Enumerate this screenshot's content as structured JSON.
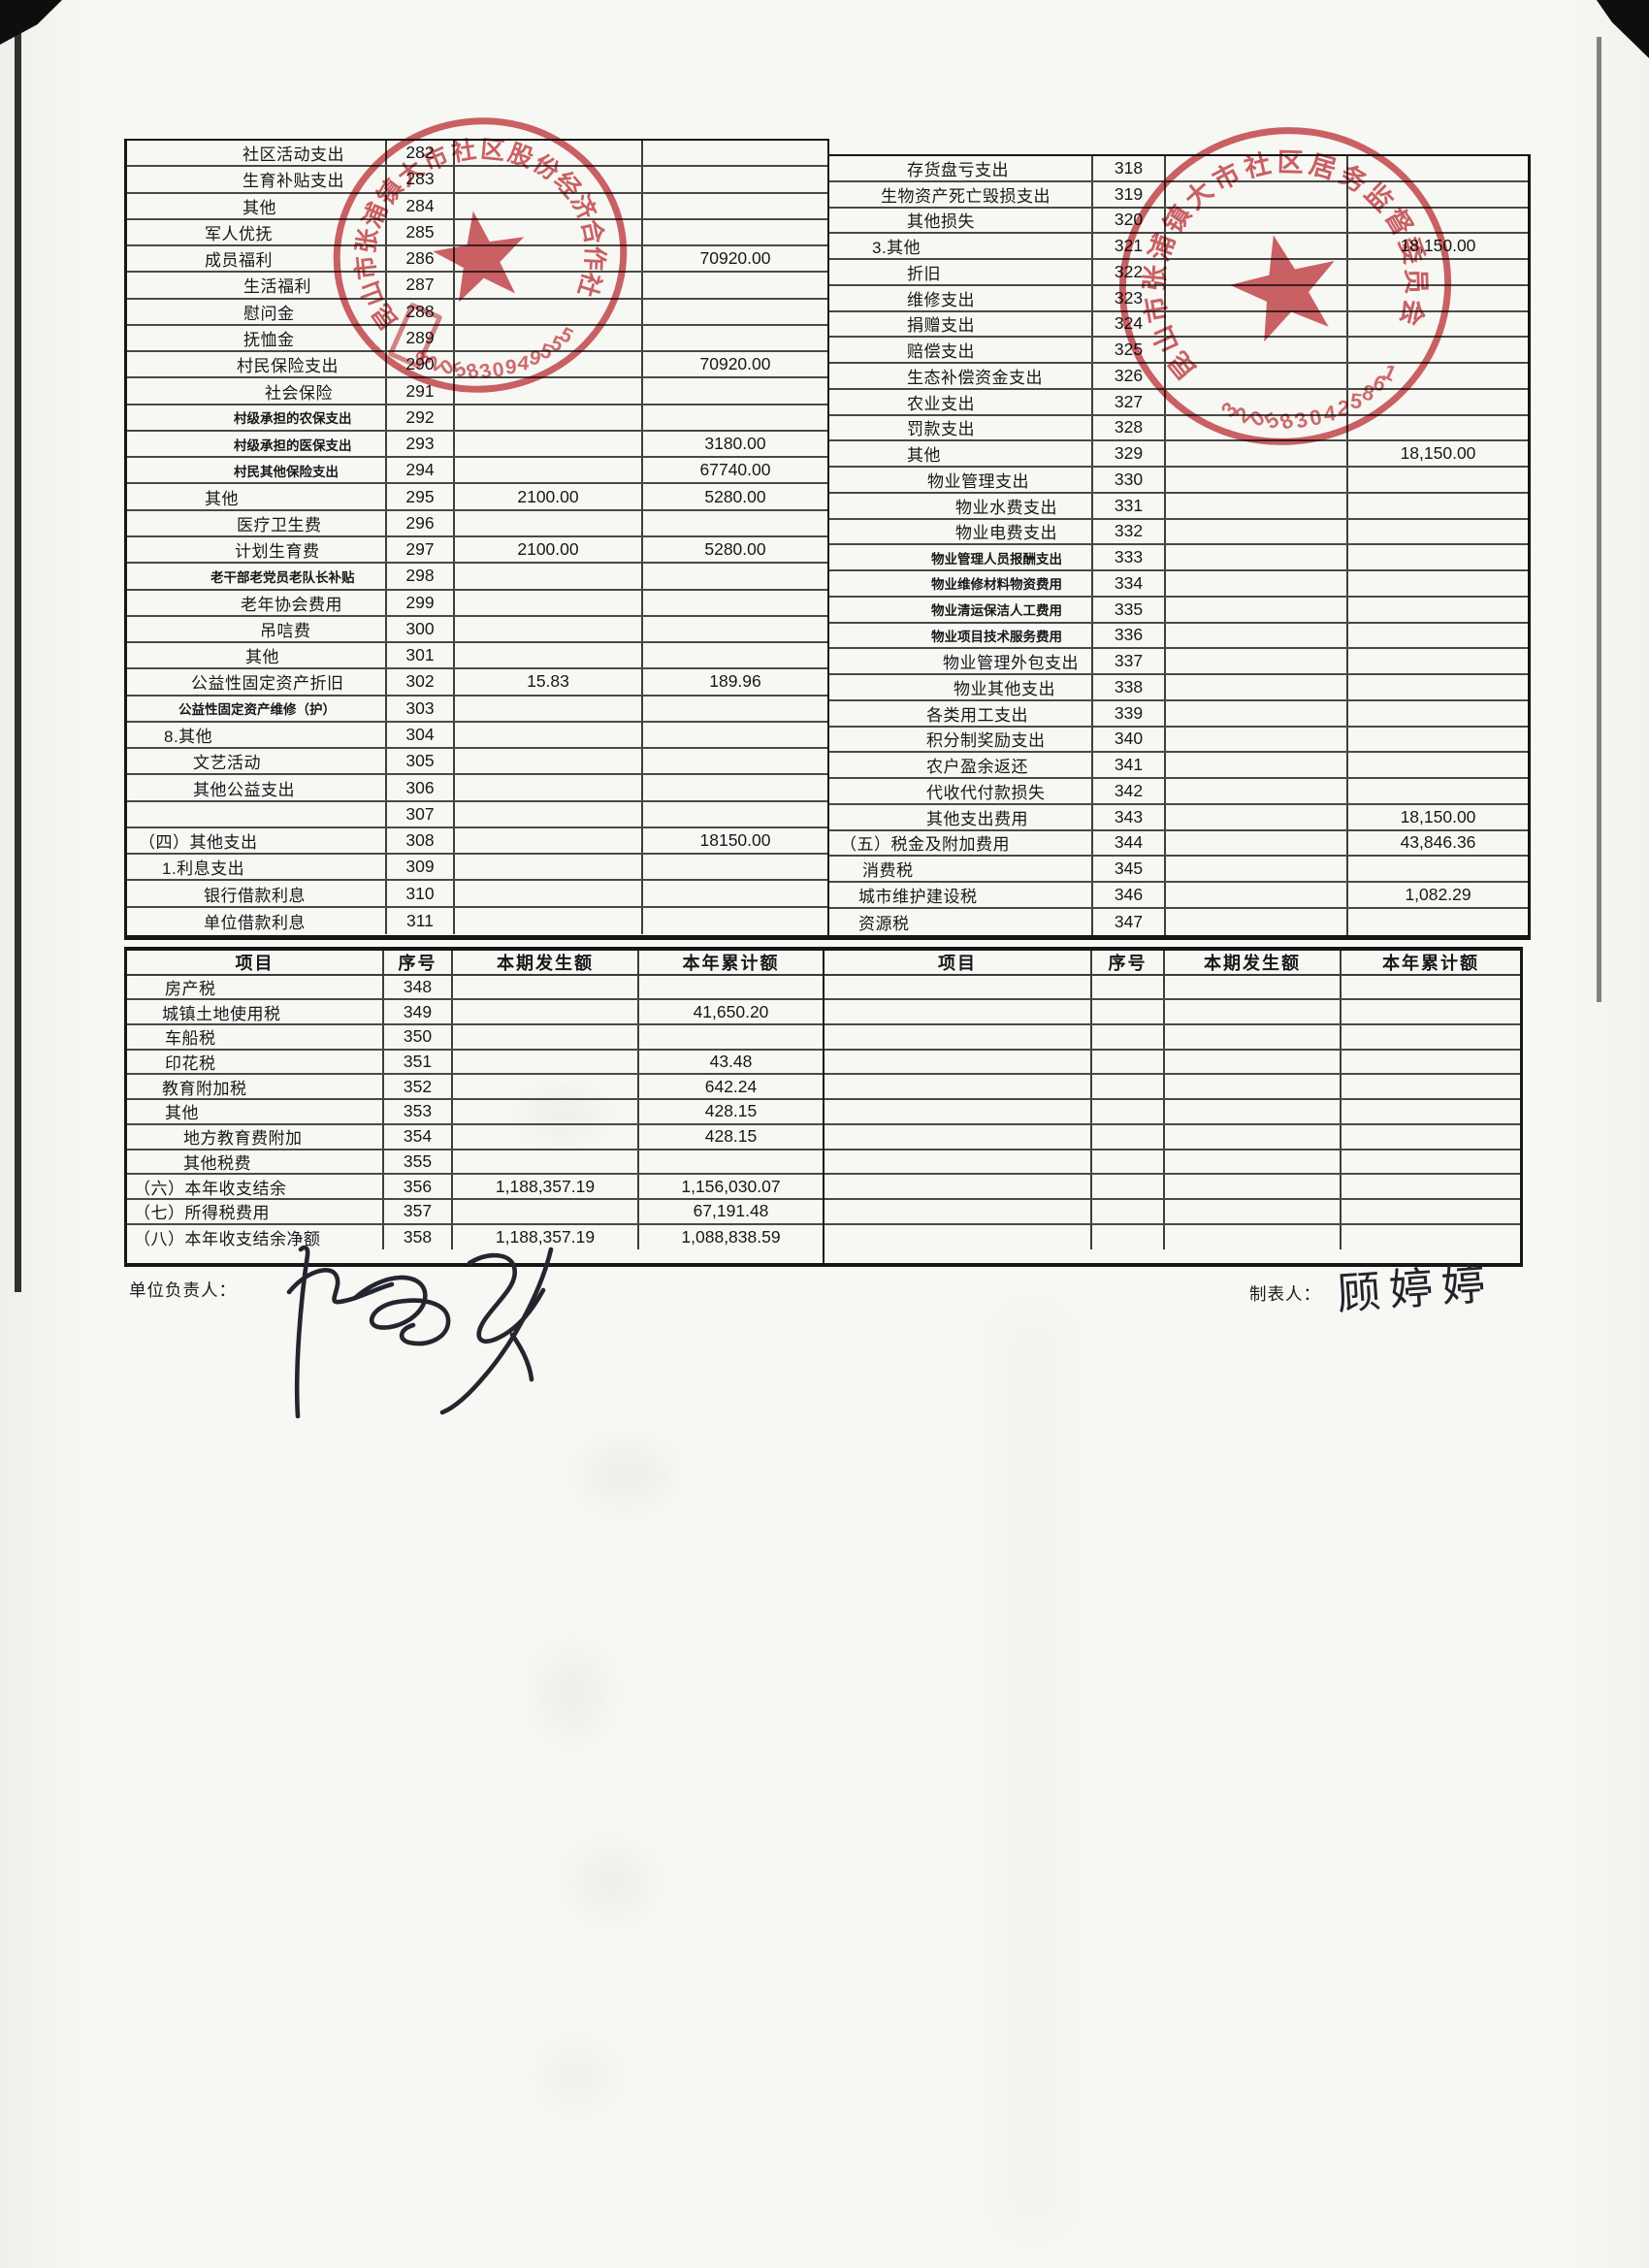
{
  "colors": {
    "stamp_red": "#c8474d",
    "line_dark": "#2c2a27",
    "paper": "#f6f6f2",
    "ink": "#18181a"
  },
  "footer": {
    "unit_head_label": "单位负责人：",
    "preparer_label": "制表人：",
    "preparer_name": "顾婷婷"
  },
  "stamps": [
    {
      "text": "昆山市张浦镇大市社区股份经济合作社",
      "number": "3205830949555"
    },
    {
      "text": "昆山市张浦镇大市社区居务监督委员会",
      "number": "3205830425861"
    }
  ],
  "table1": {
    "left_rows": [
      {
        "label": "社区活动支出",
        "no": "282",
        "indent": 119
      },
      {
        "label": "生育补贴支出",
        "no": "283",
        "indent": 119
      },
      {
        "label": "其他",
        "no": "284",
        "indent": 119
      },
      {
        "label": "军人优抚",
        "no": "285",
        "indent": 80
      },
      {
        "label": "成员福利",
        "no": "286",
        "ytd": "70920.00",
        "indent": 80
      },
      {
        "label": "生活福利",
        "no": "287",
        "indent": 120
      },
      {
        "label": "慰问金",
        "no": "288",
        "indent": 120
      },
      {
        "label": "抚恤金",
        "no": "289",
        "indent": 120
      },
      {
        "label": "村民保险支出",
        "no": "290",
        "ytd": "70920.00",
        "indent": 113
      },
      {
        "label": "社会保险",
        "no": "291",
        "indent": 142
      },
      {
        "label": "村级承担的农保支出",
        "no": "292",
        "indent": 110,
        "small": true
      },
      {
        "label": "村级承担的医保支出",
        "no": "293",
        "ytd": "3180.00",
        "indent": 110,
        "small": true
      },
      {
        "label": "村民其他保险支出",
        "no": "294",
        "ytd": "67740.00",
        "indent": 110,
        "small": true
      },
      {
        "label": "其他",
        "no": "295",
        "cur": "2100.00",
        "ytd": "5280.00",
        "indent": 80
      },
      {
        "label": "医疗卫生费",
        "no": "296",
        "indent": 113
      },
      {
        "label": "计划生育费",
        "no": "297",
        "cur": "2100.00",
        "ytd": "5280.00",
        "indent": 111
      },
      {
        "label": "老干部老党员老队长补贴",
        "no": "298",
        "indent": 86,
        "small": true
      },
      {
        "label": "老年协会费用",
        "no": "299",
        "indent": 117
      },
      {
        "label": "吊唁费",
        "no": "300",
        "indent": 137
      },
      {
        "label": "其他",
        "no": "301",
        "indent": 122
      },
      {
        "label": "公益性固定资产折旧",
        "no": "302",
        "cur": "15.83",
        "ytd": "189.96",
        "indent": 66
      },
      {
        "label": "公益性固定资产维修（护）",
        "no": "303",
        "indent": 53,
        "small": true
      },
      {
        "label": "8.其他",
        "no": "304",
        "indent": 38
      },
      {
        "label": "文艺活动",
        "no": "305",
        "indent": 68
      },
      {
        "label": "其他公益支出",
        "no": "306",
        "indent": 68
      },
      {
        "label": "",
        "no": "307",
        "indent": 12
      },
      {
        "label": "（四）其他支出",
        "no": "308",
        "ytd": "18150.00",
        "indent": 12
      },
      {
        "label": "1.利息支出",
        "no": "309",
        "indent": 36
      },
      {
        "label": "银行借款利息",
        "no": "310",
        "indent": 79
      },
      {
        "label": "单位借款利息",
        "no": "311",
        "indent": 79
      }
    ],
    "right_rows": [
      {
        "label": "存货盘亏支出",
        "no": "318",
        "indent": 80
      },
      {
        "label": "生物资产死亡毁损支出",
        "no": "319",
        "indent": 53
      },
      {
        "label": "其他损失",
        "no": "320",
        "indent": 80
      },
      {
        "label": "3.其他",
        "no": "321",
        "ytd": "18,150.00",
        "indent": 44
      },
      {
        "label": "折旧",
        "no": "322",
        "indent": 80
      },
      {
        "label": "维修支出",
        "no": "323",
        "indent": 80
      },
      {
        "label": "捐赠支出",
        "no": "324",
        "indent": 80
      },
      {
        "label": "赔偿支出",
        "no": "325",
        "indent": 80
      },
      {
        "label": "生态补偿资金支出",
        "no": "326",
        "indent": 80
      },
      {
        "label": "农业支出",
        "no": "327",
        "indent": 80
      },
      {
        "label": "罚款支出",
        "no": "328",
        "indent": 80
      },
      {
        "label": "其他",
        "no": "329",
        "ytd": "18,150.00",
        "indent": 80
      },
      {
        "label": "物业管理支出",
        "no": "330",
        "indent": 101
      },
      {
        "label": "物业水费支出",
        "no": "331",
        "indent": 130
      },
      {
        "label": "物业电费支出",
        "no": "332",
        "indent": 130
      },
      {
        "label": "物业管理人员报酬支出",
        "no": "333",
        "indent": 105,
        "small": true
      },
      {
        "label": "物业维修材料物资费用",
        "no": "334",
        "indent": 105,
        "small": true
      },
      {
        "label": "物业清运保洁人工费用",
        "no": "335",
        "indent": 105,
        "small": true
      },
      {
        "label": "物业项目技术服务费用",
        "no": "336",
        "indent": 105,
        "small": true
      },
      {
        "label": "物业管理外包支出",
        "no": "337",
        "indent": 117
      },
      {
        "label": "物业其他支出",
        "no": "338",
        "indent": 128
      },
      {
        "label": "各类用工支出",
        "no": "339",
        "indent": 100
      },
      {
        "label": "积分制奖励支出",
        "no": "340",
        "indent": 100
      },
      {
        "label": "农户盈余返还",
        "no": "341",
        "indent": 100
      },
      {
        "label": "代收代付款损失",
        "no": "342",
        "indent": 100
      },
      {
        "label": "其他支出费用",
        "no": "343",
        "ytd": "18,150.00",
        "indent": 100
      },
      {
        "label": "（五）税金及附加费用",
        "no": "344",
        "ytd": "43,846.36",
        "indent": 11
      },
      {
        "label": "消费税",
        "no": "345",
        "indent": 34
      },
      {
        "label": "城市维护建设税",
        "no": "346",
        "ytd": "1,082.29",
        "indent": 30
      },
      {
        "label": "资源税",
        "no": "347",
        "indent": 30
      }
    ]
  },
  "table2": {
    "headers": [
      "项目",
      "序号",
      "本期发生额",
      "本年累计额"
    ],
    "left_rows": [
      {
        "label": "房产税",
        "no": "348",
        "indent": 39
      },
      {
        "label": "城镇土地使用税",
        "no": "349",
        "ytd": "41,650.20",
        "indent": 36
      },
      {
        "label": "车船税",
        "no": "350",
        "indent": 39
      },
      {
        "label": "印花税",
        "no": "351",
        "ytd": "43.48",
        "indent": 39
      },
      {
        "label": "教育附加税",
        "no": "352",
        "ytd": "642.24",
        "indent": 36
      },
      {
        "label": "其他",
        "no": "353",
        "ytd": "428.15",
        "indent": 39
      },
      {
        "label": "地方教育费附加",
        "no": "354",
        "ytd": "428.15",
        "indent": 58
      },
      {
        "label": "其他税费",
        "no": "355",
        "indent": 58
      },
      {
        "label": "（六）本年收支结余",
        "no": "356",
        "cur": "1,188,357.19",
        "ytd": "1,156,030.07",
        "indent": 7
      },
      {
        "label": "（七）所得税费用",
        "no": "357",
        "ytd": "67,191.48",
        "indent": 7
      },
      {
        "label": "（八）本年收支结余净额",
        "no": "358",
        "cur": "1,188,357.19",
        "ytd": "1,088,838.59",
        "indent": 7
      }
    ],
    "right_rows": [
      {},
      {},
      {},
      {},
      {},
      {},
      {},
      {},
      {},
      {},
      {}
    ]
  }
}
